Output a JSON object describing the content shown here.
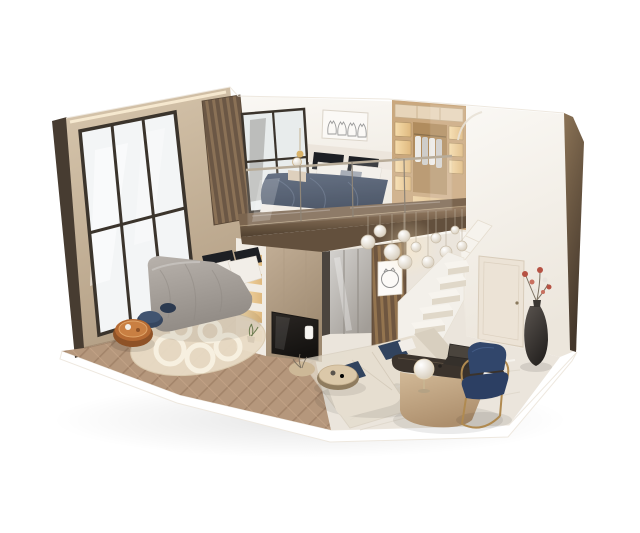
{
  "scene": {
    "description": "Photorealistic 3D cutaway dollhouse render of a two-level loft apartment on a white background. Ground floor: bedroom with gray duvet bed, navy poufs, amber tray table, cream rug on herringbone wood floor, backlit shelving divider with TV panel, mirrored hallway, wood-slat partition with round cat artwork, glass-bubble chandelier, white open staircase, beige L-shaped sofa with navy cushions, round coffee tables, curved desk with laptop and globe lamp, navy-and-gold chair, dark vase with red flowers, door. Mezzanine: bedroom with navy duvet bed, black and white pillows, four-cat line artwork, open wardrobe with hanging clothes, glass balustrade over a bronze slab edge. Left side is a full-height dark-framed window wall; right side a tall white cut wall with bronze edge.",
    "type": "architectural-interior-render",
    "view": "isometric cutaway",
    "background": "#ffffff",
    "objects": [
      {
        "name": "window-wall",
        "label": "Full-height window wall with dark mullions"
      },
      {
        "name": "loft-slat-column",
        "label": "Dark wood slat corner column"
      },
      {
        "name": "loft-bedroom",
        "label": "Mezzanine bedroom"
      },
      {
        "name": "cat-artwork",
        "label": "Framed artwork with four line-drawn cats"
      },
      {
        "name": "loft-bed",
        "label": "Bed with dark navy duvet and black/white pillows"
      },
      {
        "name": "wardrobe",
        "label": "Open backlit wardrobe with hanging clothes"
      },
      {
        "name": "glass-railing",
        "label": "Frameless glass mezzanine balustrade"
      },
      {
        "name": "mezzanine-slab",
        "label": "Bronze mezzanine floor slab"
      },
      {
        "name": "chandelier",
        "label": "Glass bubble pendant chandelier"
      },
      {
        "name": "ground-bedroom",
        "label": "Ground floor bedroom"
      },
      {
        "name": "ground-bed",
        "label": "Bed with gray duvet"
      },
      {
        "name": "poufs",
        "label": "Round navy poufs"
      },
      {
        "name": "amber-table",
        "label": "Round amber tray table"
      },
      {
        "name": "bedroom-rug",
        "label": "Cream rug with ring pattern"
      },
      {
        "name": "shelf-divider",
        "label": "White shelving divider with warm backlit niches"
      },
      {
        "name": "tv-panel",
        "label": "Taupe media panel with TV screen"
      },
      {
        "name": "mirror-hallway",
        "label": "Mirrored wardrobe hallway"
      },
      {
        "name": "slat-partition",
        "label": "Wood slat partition with round cat artwork"
      },
      {
        "name": "staircase",
        "label": "White open-riser staircase"
      },
      {
        "name": "robot-vacuum",
        "label": "Dark robot vacuum at stair base"
      },
      {
        "name": "sofa",
        "label": "Beige L-shaped sofa with navy cushions"
      },
      {
        "name": "coffee-tables",
        "label": "Round nesting coffee tables"
      },
      {
        "name": "desk",
        "label": "Curved desk with dark top, laptop and globe lamp"
      },
      {
        "name": "desk-chair",
        "label": "Navy chair with gold frame"
      },
      {
        "name": "floor-vase",
        "label": "Tall dark vase with red flowers"
      },
      {
        "name": "door",
        "label": "Cream interior door"
      },
      {
        "name": "right-wall",
        "label": "Tall white cutaway wall with bronze edge"
      },
      {
        "name": "marble-floor",
        "label": "Polished beige marble floor"
      },
      {
        "name": "wood-floor",
        "label": "Herringbone wood bedroom floor"
      }
    ]
  },
  "palette": {
    "bg": "#ffffff",
    "wall-beige-1": "#d8c7ae",
    "wall-beige-2": "#b4a086",
    "edge-dark": "#473c31",
    "frame-dark": "#3b342c",
    "glass-1": "#f3f5f6",
    "glass-2": "#e4e8ea",
    "wall-white-1": "#faf8f4",
    "wall-white-2": "#ece6dc",
    "slat-dark": "#6b5745",
    "slat-light": "#8a7156",
    "slat2-dark": "#6e5640",
    "slat2-light": "#93744f",
    "wood-floor-1": "#b5977c",
    "wood-floor-2": "#a3846a",
    "wood-seam": "#caa98a",
    "marble": "#ebe5dc",
    "marble-vein": "#d9d0c3",
    "marble-hi": "#f9f6f1",
    "bronze-1": "#9a8066",
    "bronze-2": "#50402f",
    "soffit": "#63503d",
    "duvet-navy-1": "#4d5a70",
    "duvet-navy-2": "#303c50",
    "duvet-fold": "#6b7a92",
    "duvet-gray-1": "#b8b2ac",
    "duvet-gray-2": "#918b85",
    "pillow-white": "#f2eee8",
    "pillow-black": "#1d1f24",
    "pillow-gray": "#9aa1ab",
    "headboard-cream": "#ece5dc",
    "rug-cream": "#e9dcc6",
    "rug-ring": "#f7f0e0",
    "pouf-navy": "#36465f",
    "pouf-navy-2": "#2c3a50",
    "amber-1": "#b56a33",
    "amber-2": "#8e5227",
    "amber-3": "#c97f42",
    "shelf-white": "#f1ece4",
    "glow-1": "#f6dcab",
    "glow-2": "#dfb97f",
    "tv-1": "#c2ae96",
    "tv-2": "#9d8970",
    "screen-1": "#2b2724",
    "screen-2": "#141210",
    "mirror-1": "#d4d2cf",
    "mirror-2": "#a29d97",
    "stair-white": "#f3f0ea",
    "tread": "#f7f4ee",
    "tread-shadow": "#e0d8c9",
    "sofa-1": "#e6ded0",
    "sofa-2": "#d8cfbf",
    "cushion-navy": "#31435e",
    "coffee-1": "#dbc8a9",
    "coffee-2": "#cdb897",
    "coffee-base": "#8f7c5f",
    "desk-top": "#3b332c",
    "desk-base-1": "#d2b997",
    "desk-base-2": "#ad8f6d",
    "chair-navy": "#2c3f63",
    "chair-navy-2": "#31466b",
    "gold": "#b08a50",
    "vase-1": "#5a544f",
    "vase-2": "#262321",
    "flower-red": "#b65243",
    "flower-pink": "#c86f5e",
    "flower-white": "#e8e3dc",
    "stem": "#7d7262",
    "wardrobe-1": "#caa87e",
    "wardrobe-2": "#b08c5e",
    "wardrobe-box": "#e7d5ba",
    "door-cream": "#ece3d6",
    "door-line": "#d8ccba",
    "bubble-edge": "#cfc3ae",
    "lamp-gold": "#d9b36a",
    "outline": "#eee8df",
    "cloth-white": "#eceae6",
    "cloth-gray": "#cfcdc9"
  }
}
